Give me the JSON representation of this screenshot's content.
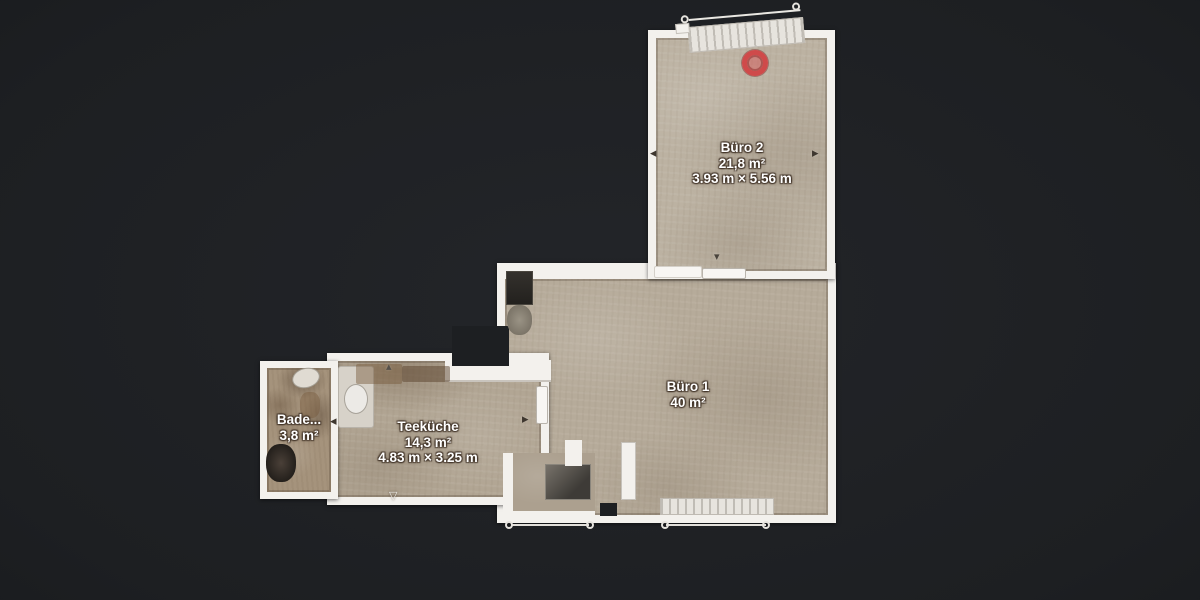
{
  "scene": {
    "background": "#1f2124",
    "wall_color": "#f3f1ed",
    "floor_color": "#b6ab9a",
    "marker_color": "#cf4a4a"
  },
  "rooms": [
    {
      "name": "Büro 2",
      "area": "21,8 m²",
      "dimensions": "3.93 m × 5.56 m"
    },
    {
      "name": "Büro 1",
      "area": "40 m²",
      "dimensions": ""
    },
    {
      "name": "Teeküche",
      "area": "14,3 m²",
      "dimensions": "4.83 m × 3.25 m"
    },
    {
      "name": "Bade...",
      "area": "3,8 m²",
      "dimensions": ""
    }
  ],
  "icons": {
    "nav_left": "◂",
    "nav_right": "▸",
    "door_down": "▾",
    "door_up": "▴",
    "door_open_down": "▽"
  }
}
